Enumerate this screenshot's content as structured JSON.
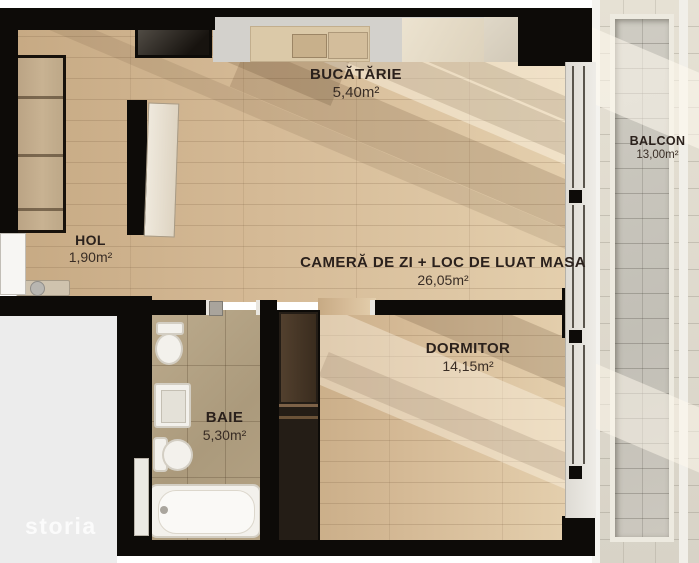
{
  "page": {
    "watermark": "storia",
    "background": "#ffffff"
  },
  "palette": {
    "wall": "#0d0b08",
    "wood_floor": "#d5ba96",
    "wood_floor_light": "#e4cfad",
    "bath_tile": "#ab9a7c",
    "balcony_tile": "#d8d3c7",
    "balcony_recess": "#c2bfb6",
    "molding": "#eeebe1",
    "kitchen_counter": "#d3d1cc",
    "fixture_white": "#f3f1ec",
    "label_text": "#2b211c",
    "outside_area": "#ececec",
    "watermark_text": "#fbfbfb"
  },
  "rooms": [
    {
      "id": "bucatarie",
      "label": "BUCĂTĂRIE",
      "area": "5,40m²"
    },
    {
      "id": "hol",
      "label": "HOL",
      "area": "1,90m²"
    },
    {
      "id": "camera_de_zi",
      "label": "CAMERĂ DE ZI + LOC DE LUAT MASA",
      "area": "26,05m²"
    },
    {
      "id": "dormitor",
      "label": "DORMITOR",
      "area": "14,15m²"
    },
    {
      "id": "baie",
      "label": "BAIE",
      "area": "5,30m²"
    },
    {
      "id": "balcon",
      "label": "BALCON",
      "area": "13,00m²"
    }
  ]
}
